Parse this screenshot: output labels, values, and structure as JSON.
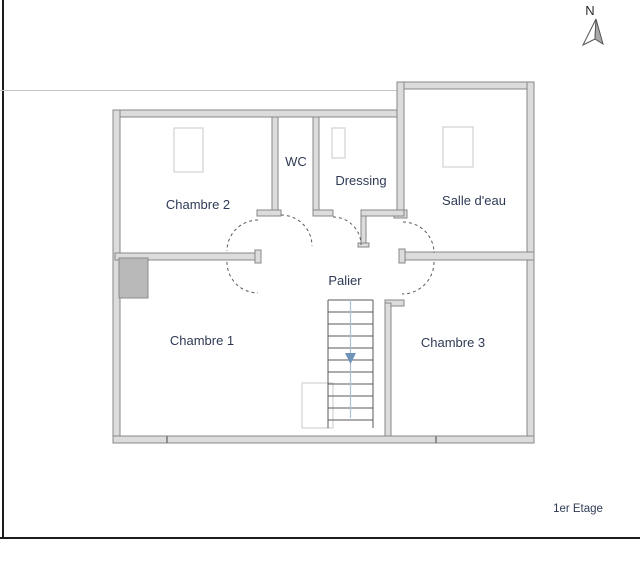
{
  "compass": {
    "label": "N"
  },
  "floor": {
    "label": "1er Etage"
  },
  "rooms": [
    {
      "id": "chambre-2",
      "label": "Chambre 2"
    },
    {
      "id": "wc",
      "label": "WC"
    },
    {
      "id": "dressing",
      "label": "Dressing"
    },
    {
      "id": "salle-deau",
      "label": "Salle d'eau"
    },
    {
      "id": "palier",
      "label": "Palier"
    },
    {
      "id": "chambre-1",
      "label": "Chambre 1"
    },
    {
      "id": "chambre-3",
      "label": "Chambre 3"
    }
  ],
  "colors": {
    "label": "#2e3a55",
    "wall_fill": "#dcdcdc",
    "wall_stroke": "#878787",
    "frame": "#1c1c1c",
    "faint_line": "#c8c8c8",
    "fixture_stroke": "#d2d2d2",
    "block_fill": "#b9b9b9",
    "stair_stroke": "#5a5a5a",
    "stair_center": "#a9c0d4",
    "stair_arrow": "#6f94ba",
    "compass_fill": "#a8a8a8"
  }
}
